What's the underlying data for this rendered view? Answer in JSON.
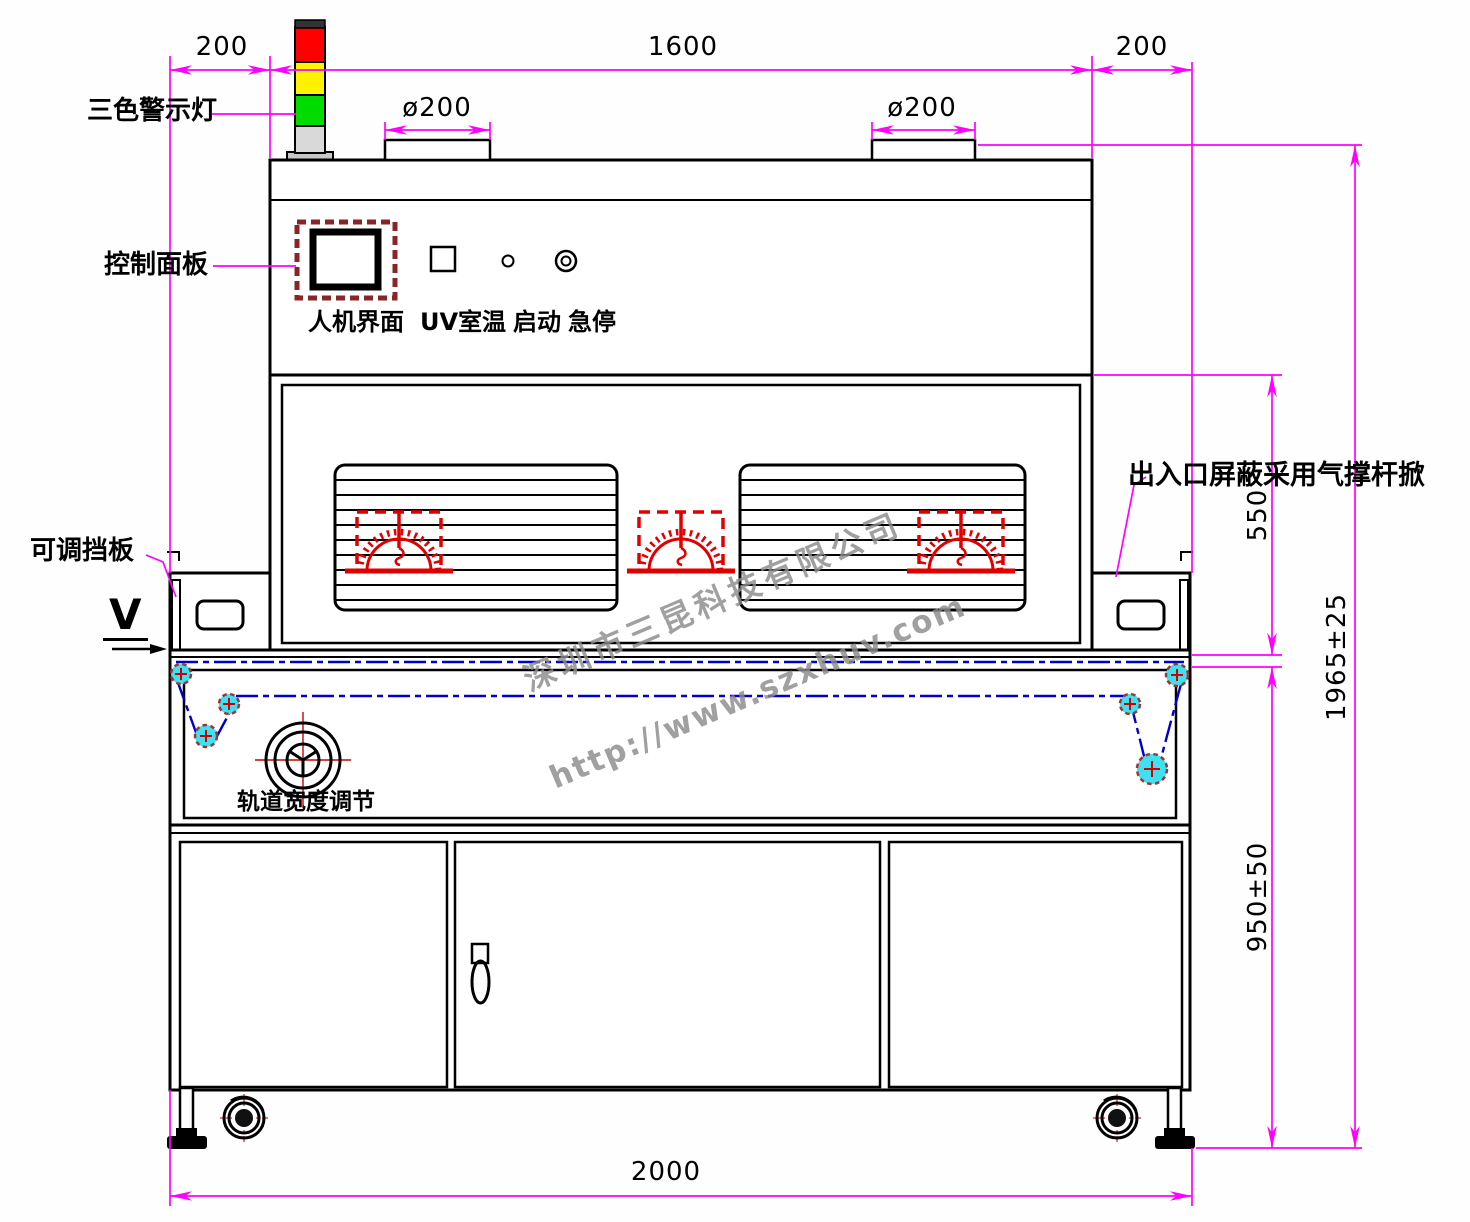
{
  "drawing": {
    "labels": {
      "warning_light": "三色警示灯",
      "control_panel": "控制面板",
      "hmi": "人机界面",
      "uv_room_temp": "UV室温",
      "start": "启动",
      "emergency_stop": "急停",
      "adjustable_baffle": "可调挡板",
      "entry_exit_shield": "出入口屏蔽采用气撑杆掀",
      "track_width_adjust": "轨道宽度调节",
      "section_marker": "V"
    },
    "dimensions": {
      "left_offset": "200",
      "body_width": "1600",
      "right_offset": "200",
      "left_vent_diameter": "ø200",
      "right_vent_diameter": "ø200",
      "chamber_height": "550",
      "overall_height": "1965±25",
      "conveyor_height": "950±50",
      "overall_width": "2000"
    },
    "watermark": {
      "company": "深圳市三昆科技有限公司",
      "website": "http://www.szxhuv.com"
    },
    "colors": {
      "dimension": "#FF00FF",
      "outline": "#000000",
      "uv_lamp": "#E00000",
      "belt": "#0000C8",
      "pulley_fill": "#3FE0EF",
      "warning_red": "#FF0000",
      "warning_yellow": "#FFF200",
      "warning_green": "#00DC00"
    }
  }
}
